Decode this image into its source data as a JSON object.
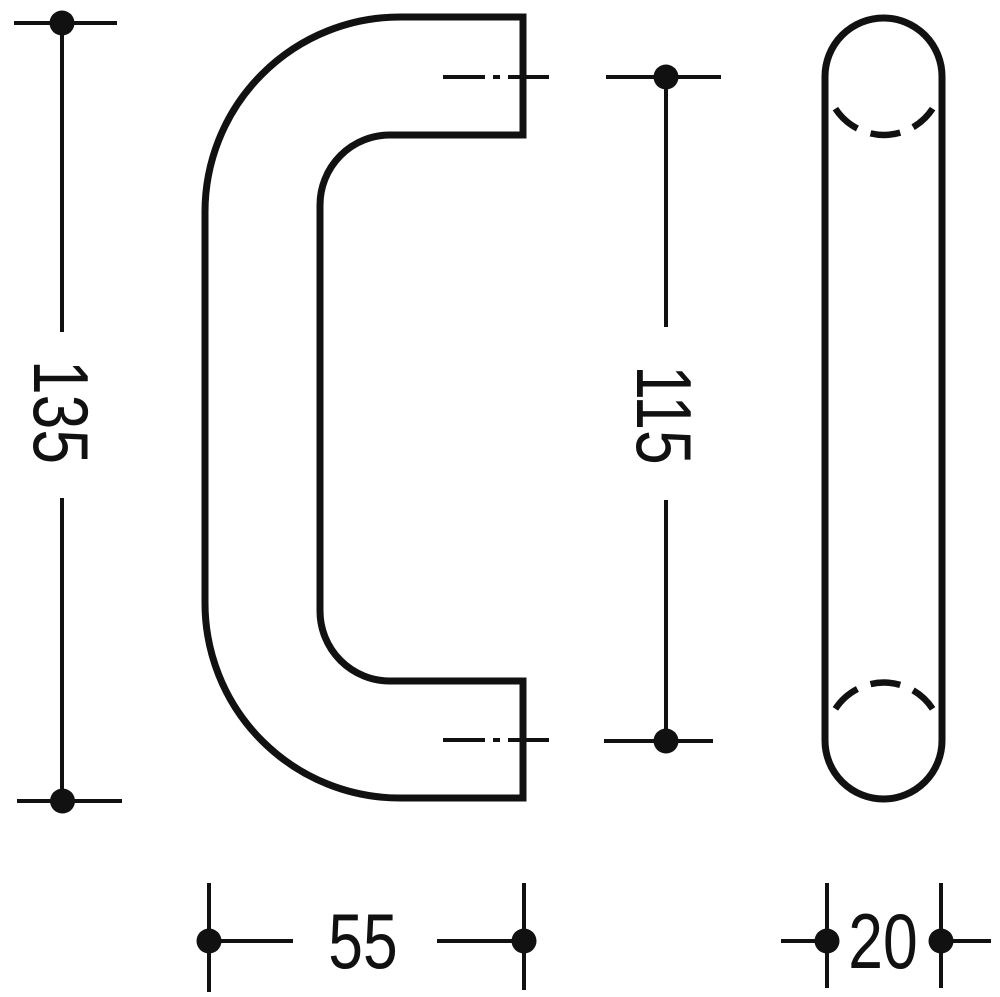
{
  "drawing": {
    "title": "door pull handle technical drawing",
    "colors": {
      "ink": "#111111",
      "background": "#ffffff"
    },
    "dimensions": {
      "overall_height": "135",
      "centers_distance": "115",
      "projection_depth": "55",
      "tube_diameter": "20"
    }
  }
}
